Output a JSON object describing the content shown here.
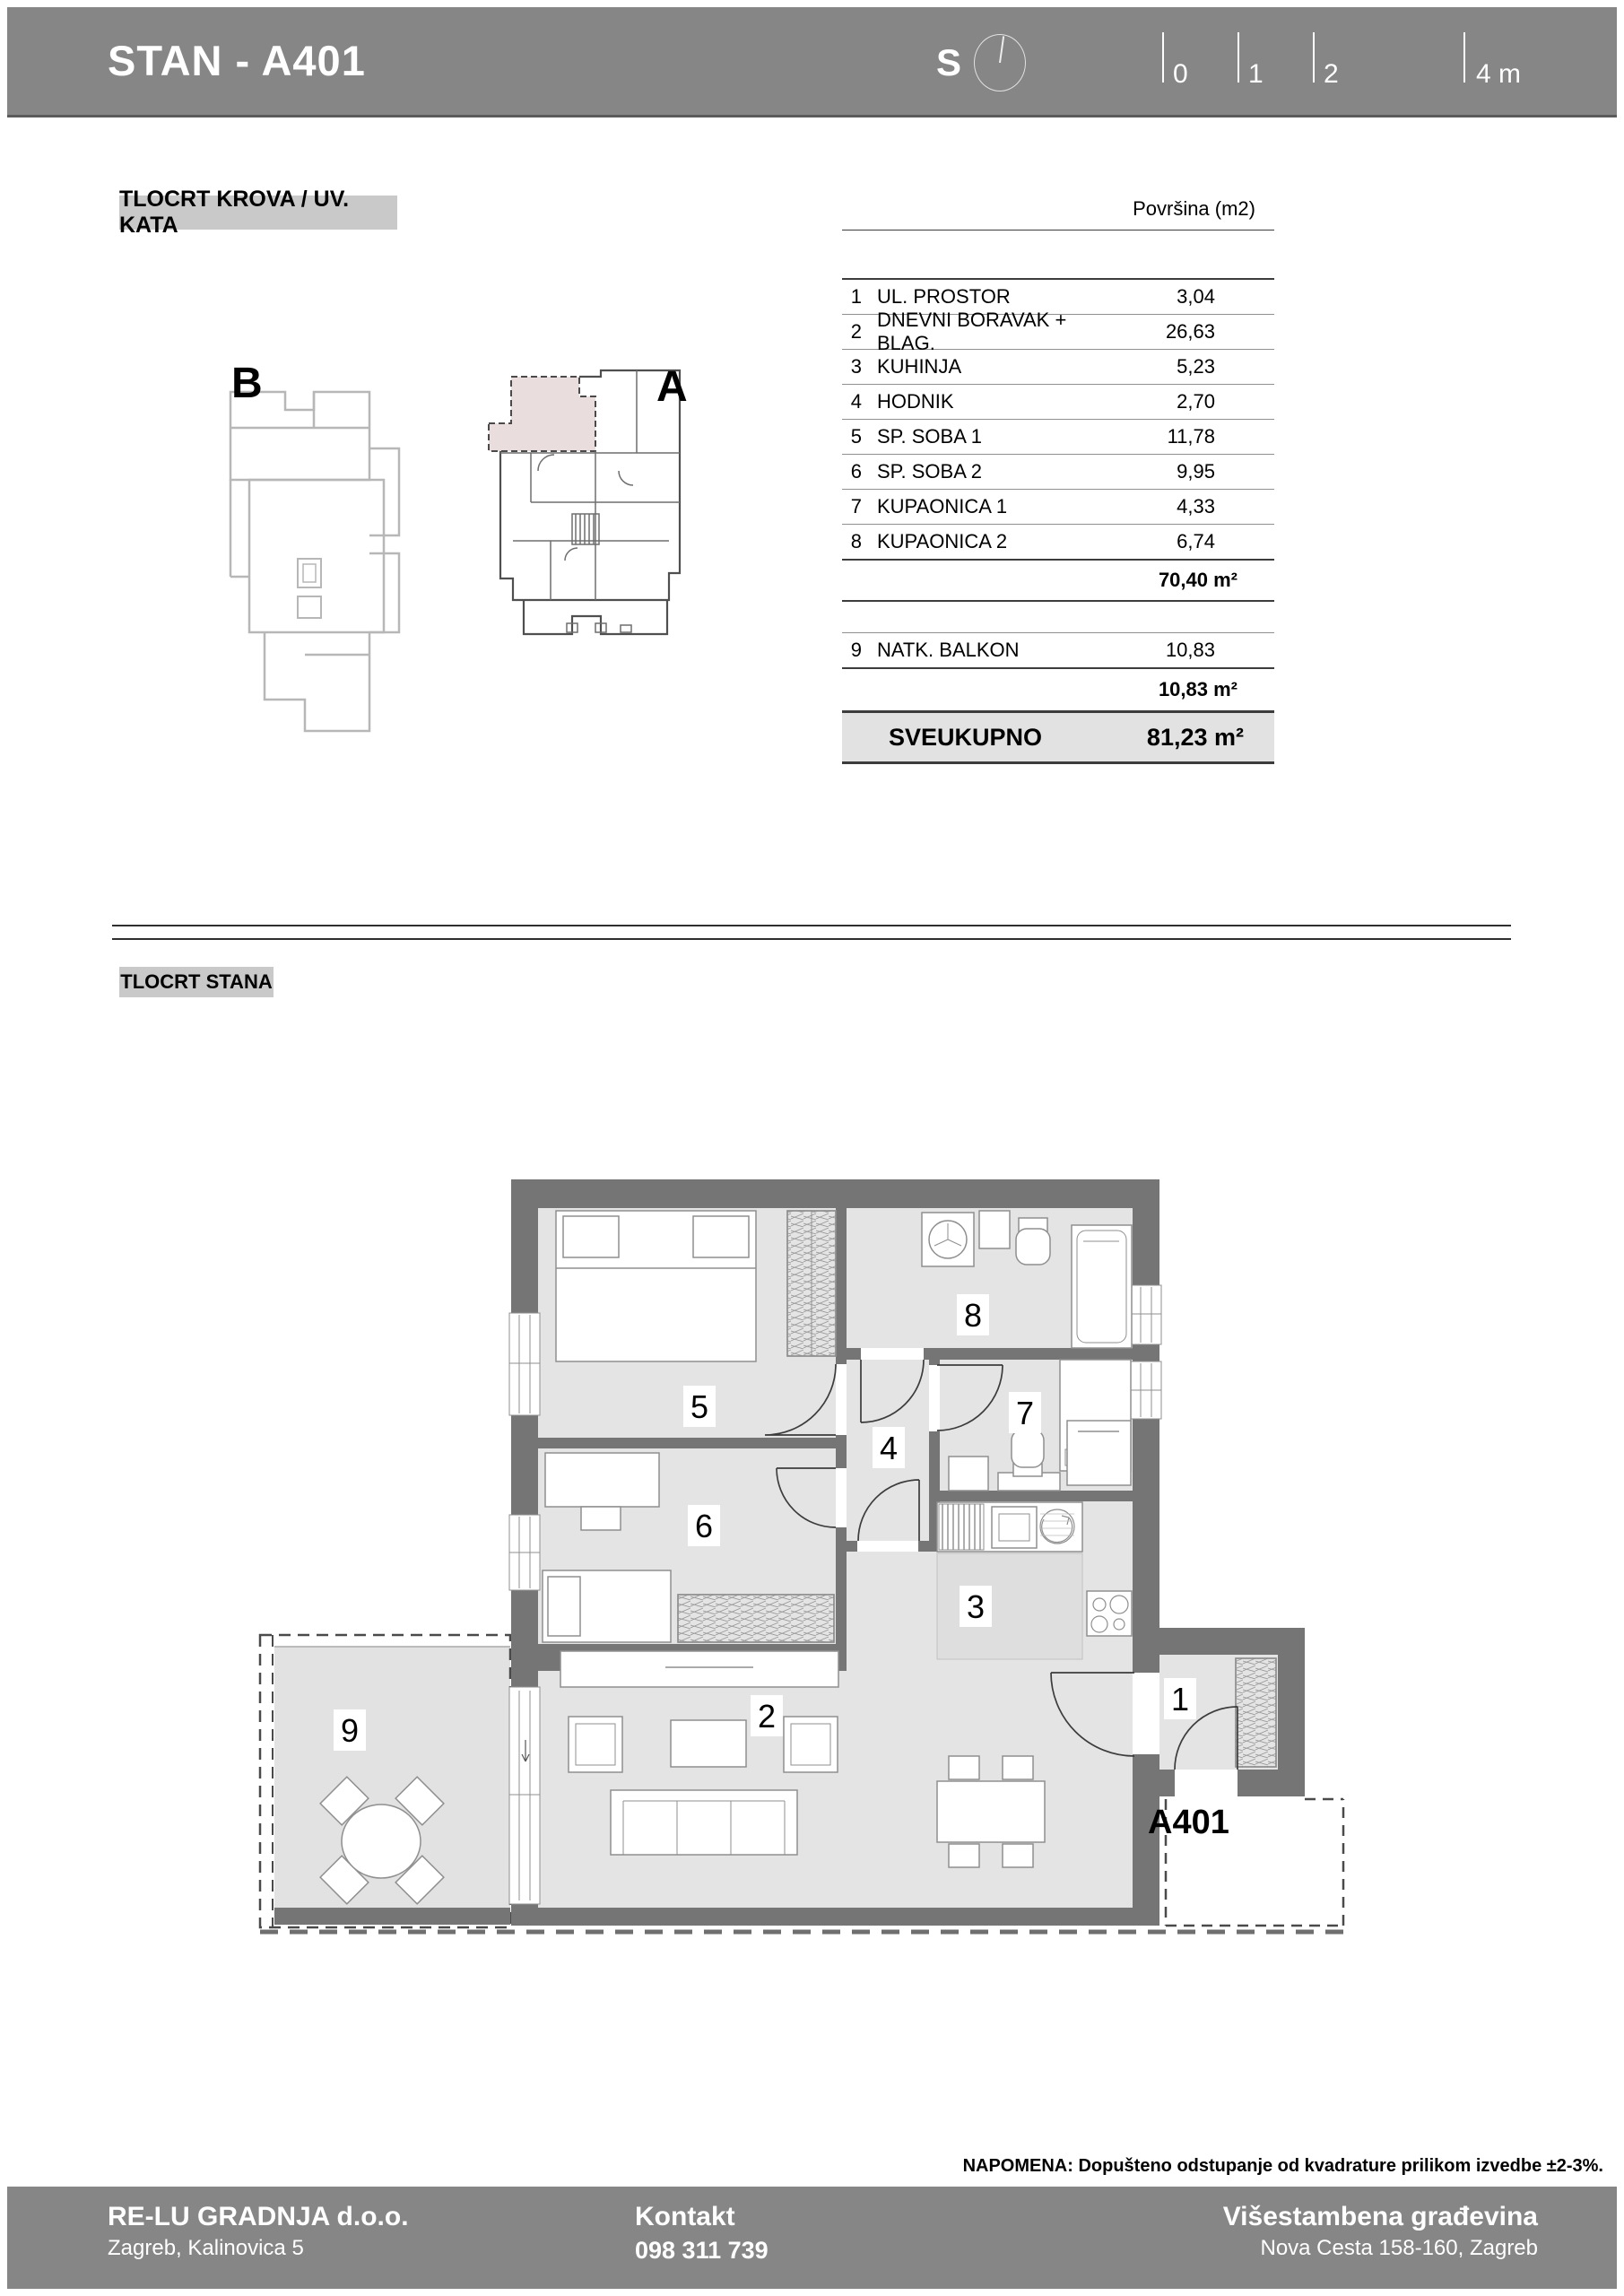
{
  "header": {
    "title": "STAN - A401",
    "compass_label": "S",
    "scale": {
      "tick_labels": [
        "0",
        "1",
        "2"
      ],
      "end_label": "4 m"
    }
  },
  "sections": {
    "roof_plan_label": "TLOCRT KROVA / UV. KATA",
    "unit_plan_label": "TLOCRT STANA"
  },
  "site": {
    "building_b_label": "B",
    "building_a_label": "A"
  },
  "area_table": {
    "column_header": "Površina (m2)",
    "rows": [
      {
        "num": "1",
        "name": "UL. PROSTOR",
        "area": "3,04"
      },
      {
        "num": "2",
        "name": "DNEVNI BORAVAK + BLAG.",
        "area": "26,63"
      },
      {
        "num": "3",
        "name": "KUHINJA",
        "area": "5,23"
      },
      {
        "num": "4",
        "name": "HODNIK",
        "area": "2,70"
      },
      {
        "num": "5",
        "name": "SP. SOBA 1",
        "area": "11,78"
      },
      {
        "num": "6",
        "name": "SP. SOBA 2",
        "area": "9,95"
      },
      {
        "num": "7",
        "name": "KUPAONICA 1",
        "area": "4,33"
      },
      {
        "num": "8",
        "name": "KUPAONICA 2",
        "area": "6,74"
      }
    ],
    "subtotal": "70,40 m²",
    "balcony_row": {
      "num": "9",
      "name": "NATK. BALKON",
      "area": "10,83"
    },
    "balcony_subtotal": "10,83 m²",
    "total_label": "SVEUKUPNO",
    "total_value": "81,23 m²"
  },
  "floorplan": {
    "room_labels": [
      "1",
      "2",
      "3",
      "4",
      "5",
      "6",
      "7",
      "8",
      "9"
    ],
    "unit_label": "A401"
  },
  "napomena": "NAPOMENA: Dopušteno odstupanje od kvadrature prilikom izvedbe ±2-3%.",
  "footer": {
    "company": "RE-LU GRADNJA d.o.o.",
    "company_address": "Zagreb, Kalinovica 5",
    "contact_label": "Kontakt",
    "contact_phone": "098 311 739",
    "project": "Višestambena građevina",
    "project_address": "Nova Cesta 158-160, Zagreb"
  }
}
